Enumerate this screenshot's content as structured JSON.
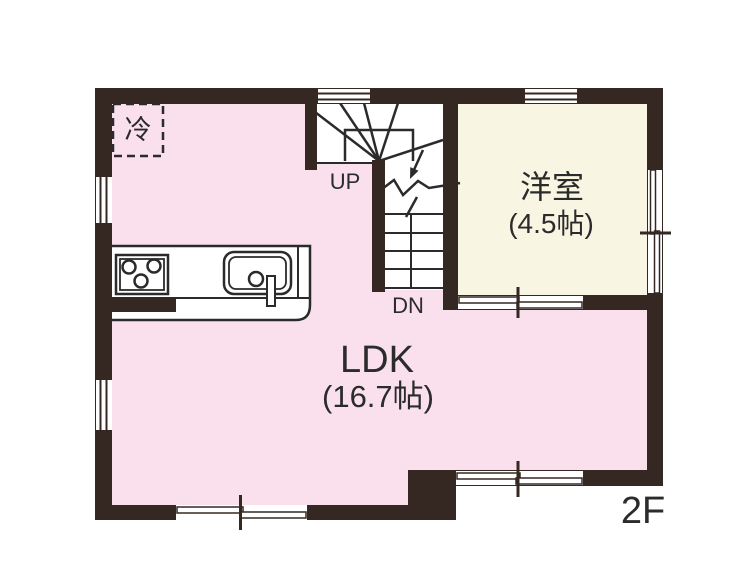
{
  "floor_label": "2F",
  "rooms": {
    "ldk": {
      "name": "LDK",
      "size": "(16.7帖)"
    },
    "western": {
      "name": "洋室",
      "size": "(4.5帖)"
    }
  },
  "stairs": {
    "up": "UP",
    "down": "DN"
  },
  "kitchen": {
    "refrigerator": "冷",
    "stove_burners": 3
  },
  "colors": {
    "ldk_fill": "#f9e0ec",
    "western_fill": "#f9f5e3",
    "stairs_fill": "#ffffff",
    "wall": "#352823",
    "line": "#2b2b2b",
    "text": "#2b2b2b",
    "background": "#ffffff"
  }
}
